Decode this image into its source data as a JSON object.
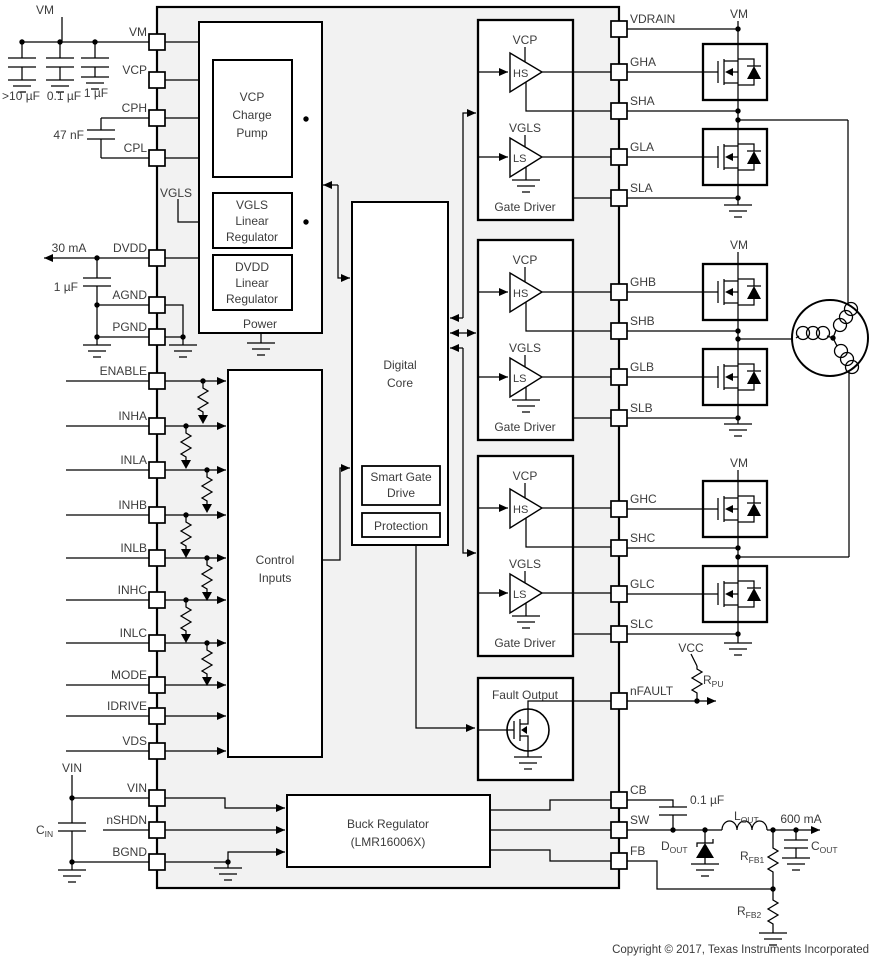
{
  "pins": {
    "left": [
      "VM",
      "VCP",
      "CPH",
      "CPL",
      "DVDD",
      "AGND",
      "PGND",
      "ENABLE",
      "INHA",
      "INLA",
      "INHB",
      "INLB",
      "INHC",
      "INLC",
      "MODE",
      "IDRIVE",
      "VDS",
      "VIN",
      "nSHDN",
      "BGND"
    ],
    "right": [
      "VDRAIN",
      "GHA",
      "SHA",
      "GLA",
      "SLA",
      "GHB",
      "SHB",
      "GLB",
      "SLB",
      "GHC",
      "SHC",
      "GLC",
      "SLC",
      "nFAULT",
      "CB",
      "SW",
      "FB"
    ]
  },
  "blocks": {
    "power": {
      "label": "Power",
      "charge_pump": {
        "l1": "VCP",
        "l2": "Charge",
        "l3": "Pump"
      },
      "vgls_reg": {
        "l1": "VGLS",
        "l2": "Linear",
        "l3": "Regulator"
      },
      "dvdd_reg": {
        "l1": "DVDD",
        "l2": "Linear",
        "l3": "Regulator"
      }
    },
    "digital_core": {
      "l1": "Digital",
      "l2": "Core"
    },
    "smart_gate_drive": {
      "l1": "Smart Gate",
      "l2": "Drive"
    },
    "protection": "Protection",
    "control_inputs": {
      "l1": "Control",
      "l2": "Inputs"
    },
    "gate_driver": {
      "label": "Gate Driver",
      "hs_supply": "VCP",
      "hs": "HS",
      "ls_supply": "VGLS",
      "ls": "LS"
    },
    "fault_output": "Fault Output",
    "buck": {
      "l1": "Buck Regulator",
      "l2": "(LMR16006X)"
    }
  },
  "labels": {
    "vm": "VM",
    "bulk_cap": ">10 µF",
    "bypass_cap": "0.1 µF",
    "vcp_cap": "1 µF",
    "flying_cap": "47 nF",
    "vgls_node": "VGLS",
    "dvdd_current": "30 mA",
    "dvdd_cap": "1 µF",
    "vcc": "VCC",
    "rpu": {
      "sym": "R",
      "sub": "PU"
    },
    "vin": "VIN",
    "cin": {
      "sym": "C",
      "sub": "IN"
    },
    "cb_cap": "0.1 µF",
    "lout": {
      "sym": "L",
      "sub": "OUT"
    },
    "iout": "600 mA",
    "dout": {
      "sym": "D",
      "sub": "OUT"
    },
    "rfb1": {
      "sym": "R",
      "sub": "FB1"
    },
    "rfb2": {
      "sym": "R",
      "sub": "FB2"
    },
    "cout": {
      "sym": "C",
      "sub": "OUT"
    }
  },
  "copyright": "Copyright © 2017, Texas Instruments Incorporated"
}
